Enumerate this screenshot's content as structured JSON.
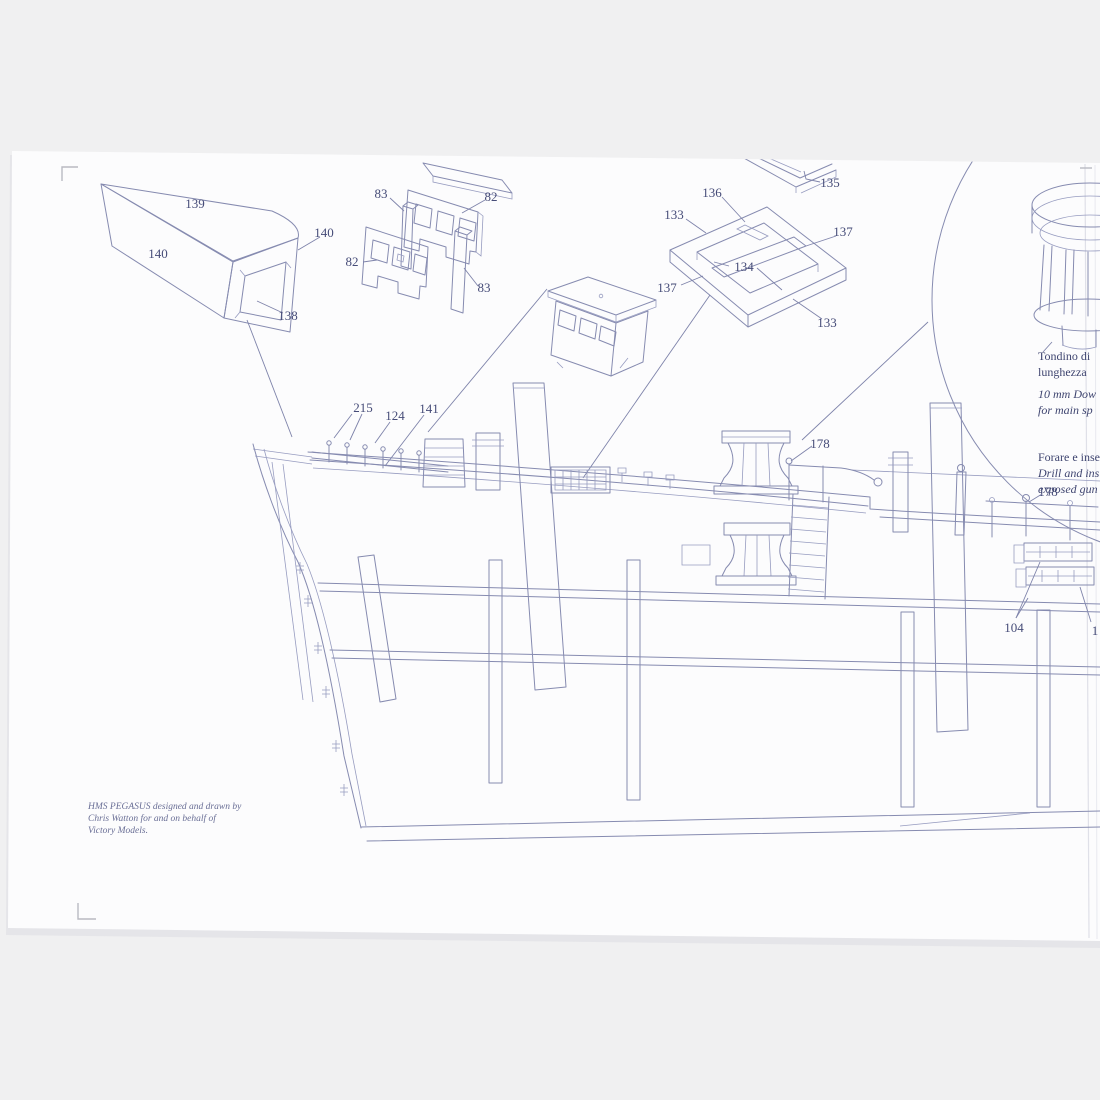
{
  "colors": {
    "background": "#f0f0f1",
    "paper": "#fcfcfd",
    "ink": "#868bb0",
    "label_ink": "#464c78",
    "shadow": "#d9dade"
  },
  "labels": [
    {
      "text": "139"
    },
    {
      "text": "140"
    },
    {
      "text": "140"
    },
    {
      "text": "138"
    },
    {
      "text": "83"
    },
    {
      "text": "82"
    },
    {
      "text": "82"
    },
    {
      "text": "83"
    },
    {
      "text": "136"
    },
    {
      "text": "133"
    },
    {
      "text": "137"
    },
    {
      "text": "134"
    },
    {
      "text": "137"
    },
    {
      "text": "133"
    },
    {
      "text": "135"
    },
    {
      "text": "215"
    },
    {
      "text": "124"
    },
    {
      "text": "141"
    },
    {
      "text": "178"
    },
    {
      "text": "178"
    },
    {
      "text": "104"
    },
    {
      "text": "1"
    }
  ],
  "notes": {
    "capstan_note": {
      "line1": "Tondino di",
      "line2": "lunghezza",
      "line3": "10 mm Dow",
      "line4": "for main sp"
    },
    "eyebolt_note": {
      "line1": "Forare e inse",
      "line2": "Drill and ins",
      "line3": "exposed gun"
    }
  },
  "credit": {
    "line1": "HMS PEGASUS designed and drawn by",
    "line2": "Chris Watton for and on behalf of",
    "line3": "Victory Models."
  }
}
